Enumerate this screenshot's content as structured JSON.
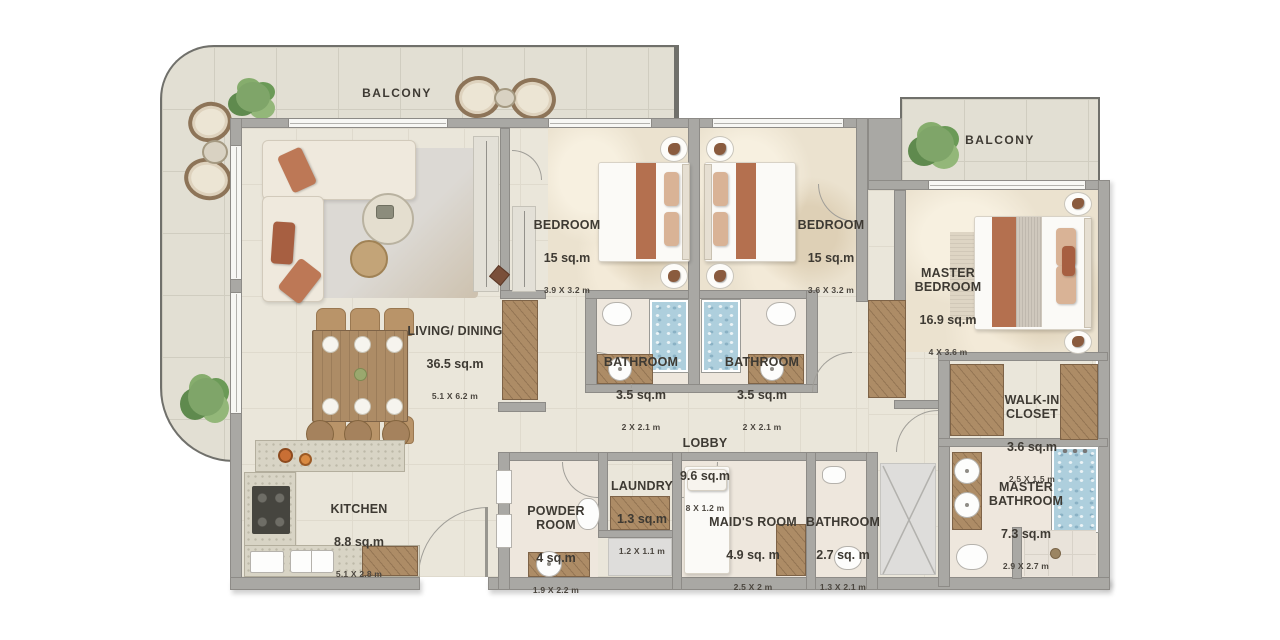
{
  "title": "3-bedroom apartment floor plan",
  "colors": {
    "wall": "#a9a8a4",
    "floor": "#eae6da",
    "balcony_floor": "#e2dfd3",
    "wood": "#ad8c66",
    "accent_terracotta": "#b4704f",
    "water_blue": "#aecfdd",
    "plant_green": "#7fa569",
    "label_text": "#3e3a33"
  },
  "balconies": [
    {
      "label": "BALCONY"
    },
    {
      "label": "BALCONY"
    }
  ],
  "rooms": [
    {
      "name": "LIVING/ DINING",
      "area": "36.5 sq.m",
      "dims": "5.1 X 6.2 m"
    },
    {
      "name": "BEDROOM",
      "area": "15 sq.m",
      "dims": "3.9 X 3.2 m"
    },
    {
      "name": "BEDROOM",
      "area": "15 sq.m",
      "dims": "3.6 X 3.2 m"
    },
    {
      "name": "MASTER\nBEDROOM",
      "area": "16.9 sq.m",
      "dims": "4 X 3.6 m"
    },
    {
      "name": "BATHROOM",
      "area": "3.5 sq.m",
      "dims": "2 X 2.1 m"
    },
    {
      "name": "BATHROOM",
      "area": "3.5 sq.m",
      "dims": "2 X 2.1 m"
    },
    {
      "name": "LOBBY",
      "area": "9.6 sq.m",
      "dims": "8 X 1.2 m"
    },
    {
      "name": "KITCHEN",
      "area": "8.8 sq.m",
      "dims": "5.1 X 2.8 m"
    },
    {
      "name": "POWDER\nROOM",
      "area": "4 sq.m",
      "dims": "1.9 X 2.2 m"
    },
    {
      "name": "LAUNDRY",
      "area": "1.3 sq.m",
      "dims": "1.2 X 1.1 m"
    },
    {
      "name": "MAID'S ROOM",
      "area": "4.9 sq. m",
      "dims": "2.5 X 2 m"
    },
    {
      "name": "BATHROOM",
      "area": "2.7 sq. m",
      "dims": "1.3 X 2.1 m"
    },
    {
      "name": "MASTER\nBATHROOM",
      "area": "7.3 sq.m",
      "dims": "2.9 X 2.7 m"
    },
    {
      "name": "WALK-IN\nCLOSET",
      "area": "3.6 sq.m",
      "dims": "2.5 X 1.5 m"
    }
  ]
}
